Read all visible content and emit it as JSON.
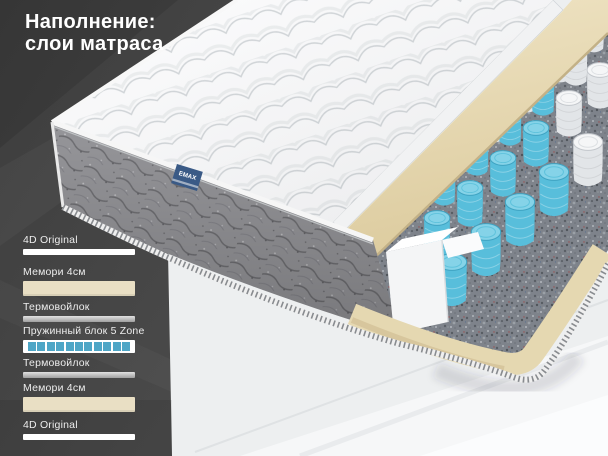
{
  "title": {
    "lines": [
      "Наполнение:",
      "слои матраса"
    ]
  },
  "layer_legend": {
    "items": [
      {
        "label": "4D Original",
        "swatch": "white"
      },
      {
        "label": "Мемори 4см",
        "swatch": "beige"
      },
      {
        "label": "Термовойлок",
        "swatch": "gray"
      },
      {
        "label": "Пружинный блок 5 Zone",
        "swatch": "springs",
        "segments": 11
      },
      {
        "label": "Термовойлок",
        "swatch": "gray"
      },
      {
        "label": "Мемори 4см",
        "swatch": "beige"
      },
      {
        "label": "4D Original",
        "swatch": "white"
      }
    ]
  },
  "illustration": {
    "brand_tag": "EMAX"
  },
  "colors": {
    "background_dark": "#434343",
    "background_light": "#edeff0",
    "title_text": "#ffffff",
    "label_text": "#ededed",
    "memory_foam_beige": "#e6d9b2",
    "spring_blue": "#58bedb",
    "legend_spring_blue": "#4ea6c6",
    "felt_gray": "#7e838b",
    "brand_tag_blue": "#3a5a86"
  }
}
